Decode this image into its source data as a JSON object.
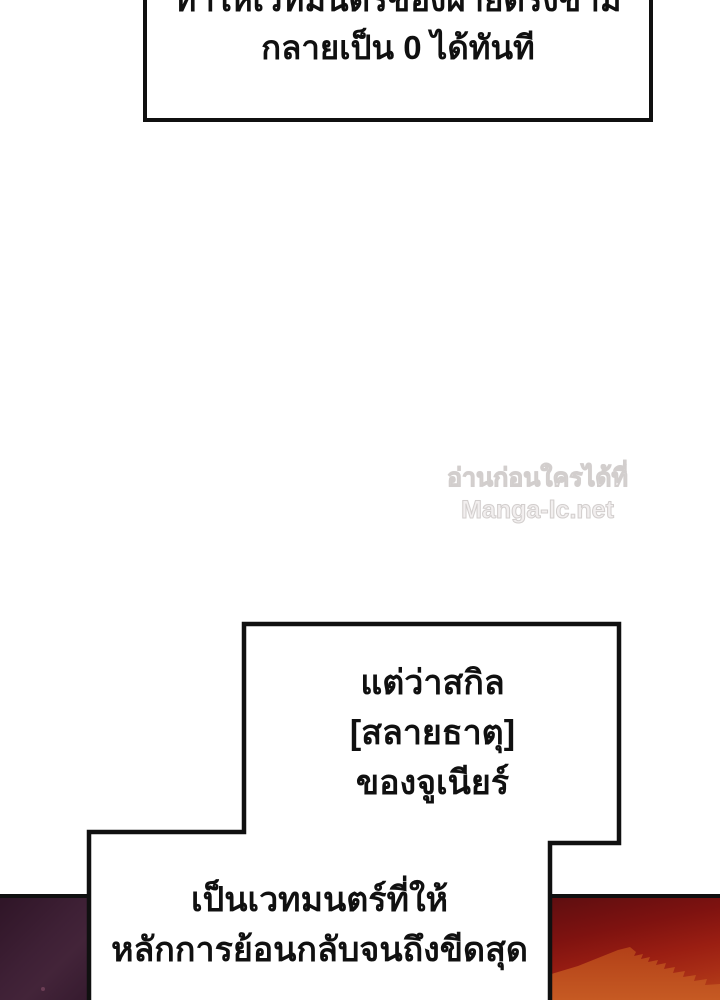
{
  "page": {
    "type": "manga-page",
    "language": "th"
  },
  "colors": {
    "ink": "#101010",
    "paper": "#ffffff",
    "watermark-fill": "#f2efef",
    "watermark-stroke": "#d2cecd",
    "art-purple-dark": "#2f1527",
    "art-purple-mid": "#3e2035",
    "art-red-dark": "#5e0e10",
    "art-red-mid": "#9a1e12",
    "art-red-ridge": "#b24018",
    "art-red-bright": "#c65a23"
  },
  "speech": {
    "top": {
      "lines": [
        "ทำให้เวทมนตร์ของฝ่ายตรงข้าม",
        "กลายเป็น 0 ได้ทันที"
      ]
    },
    "middle": {
      "lines": [
        "แต่ว่าสกิล",
        "[สลายธาตุ]",
        "ของจูเนียร์"
      ]
    },
    "bottom": {
      "lines": [
        "เป็นเวทมนตร์ที่ให้",
        "หลักการย้อนกลับจนถึงขีดสุด"
      ]
    }
  },
  "watermark": {
    "line1": "อ่านก่อนใครได้ที่",
    "line2": "Manga-lc.net"
  }
}
